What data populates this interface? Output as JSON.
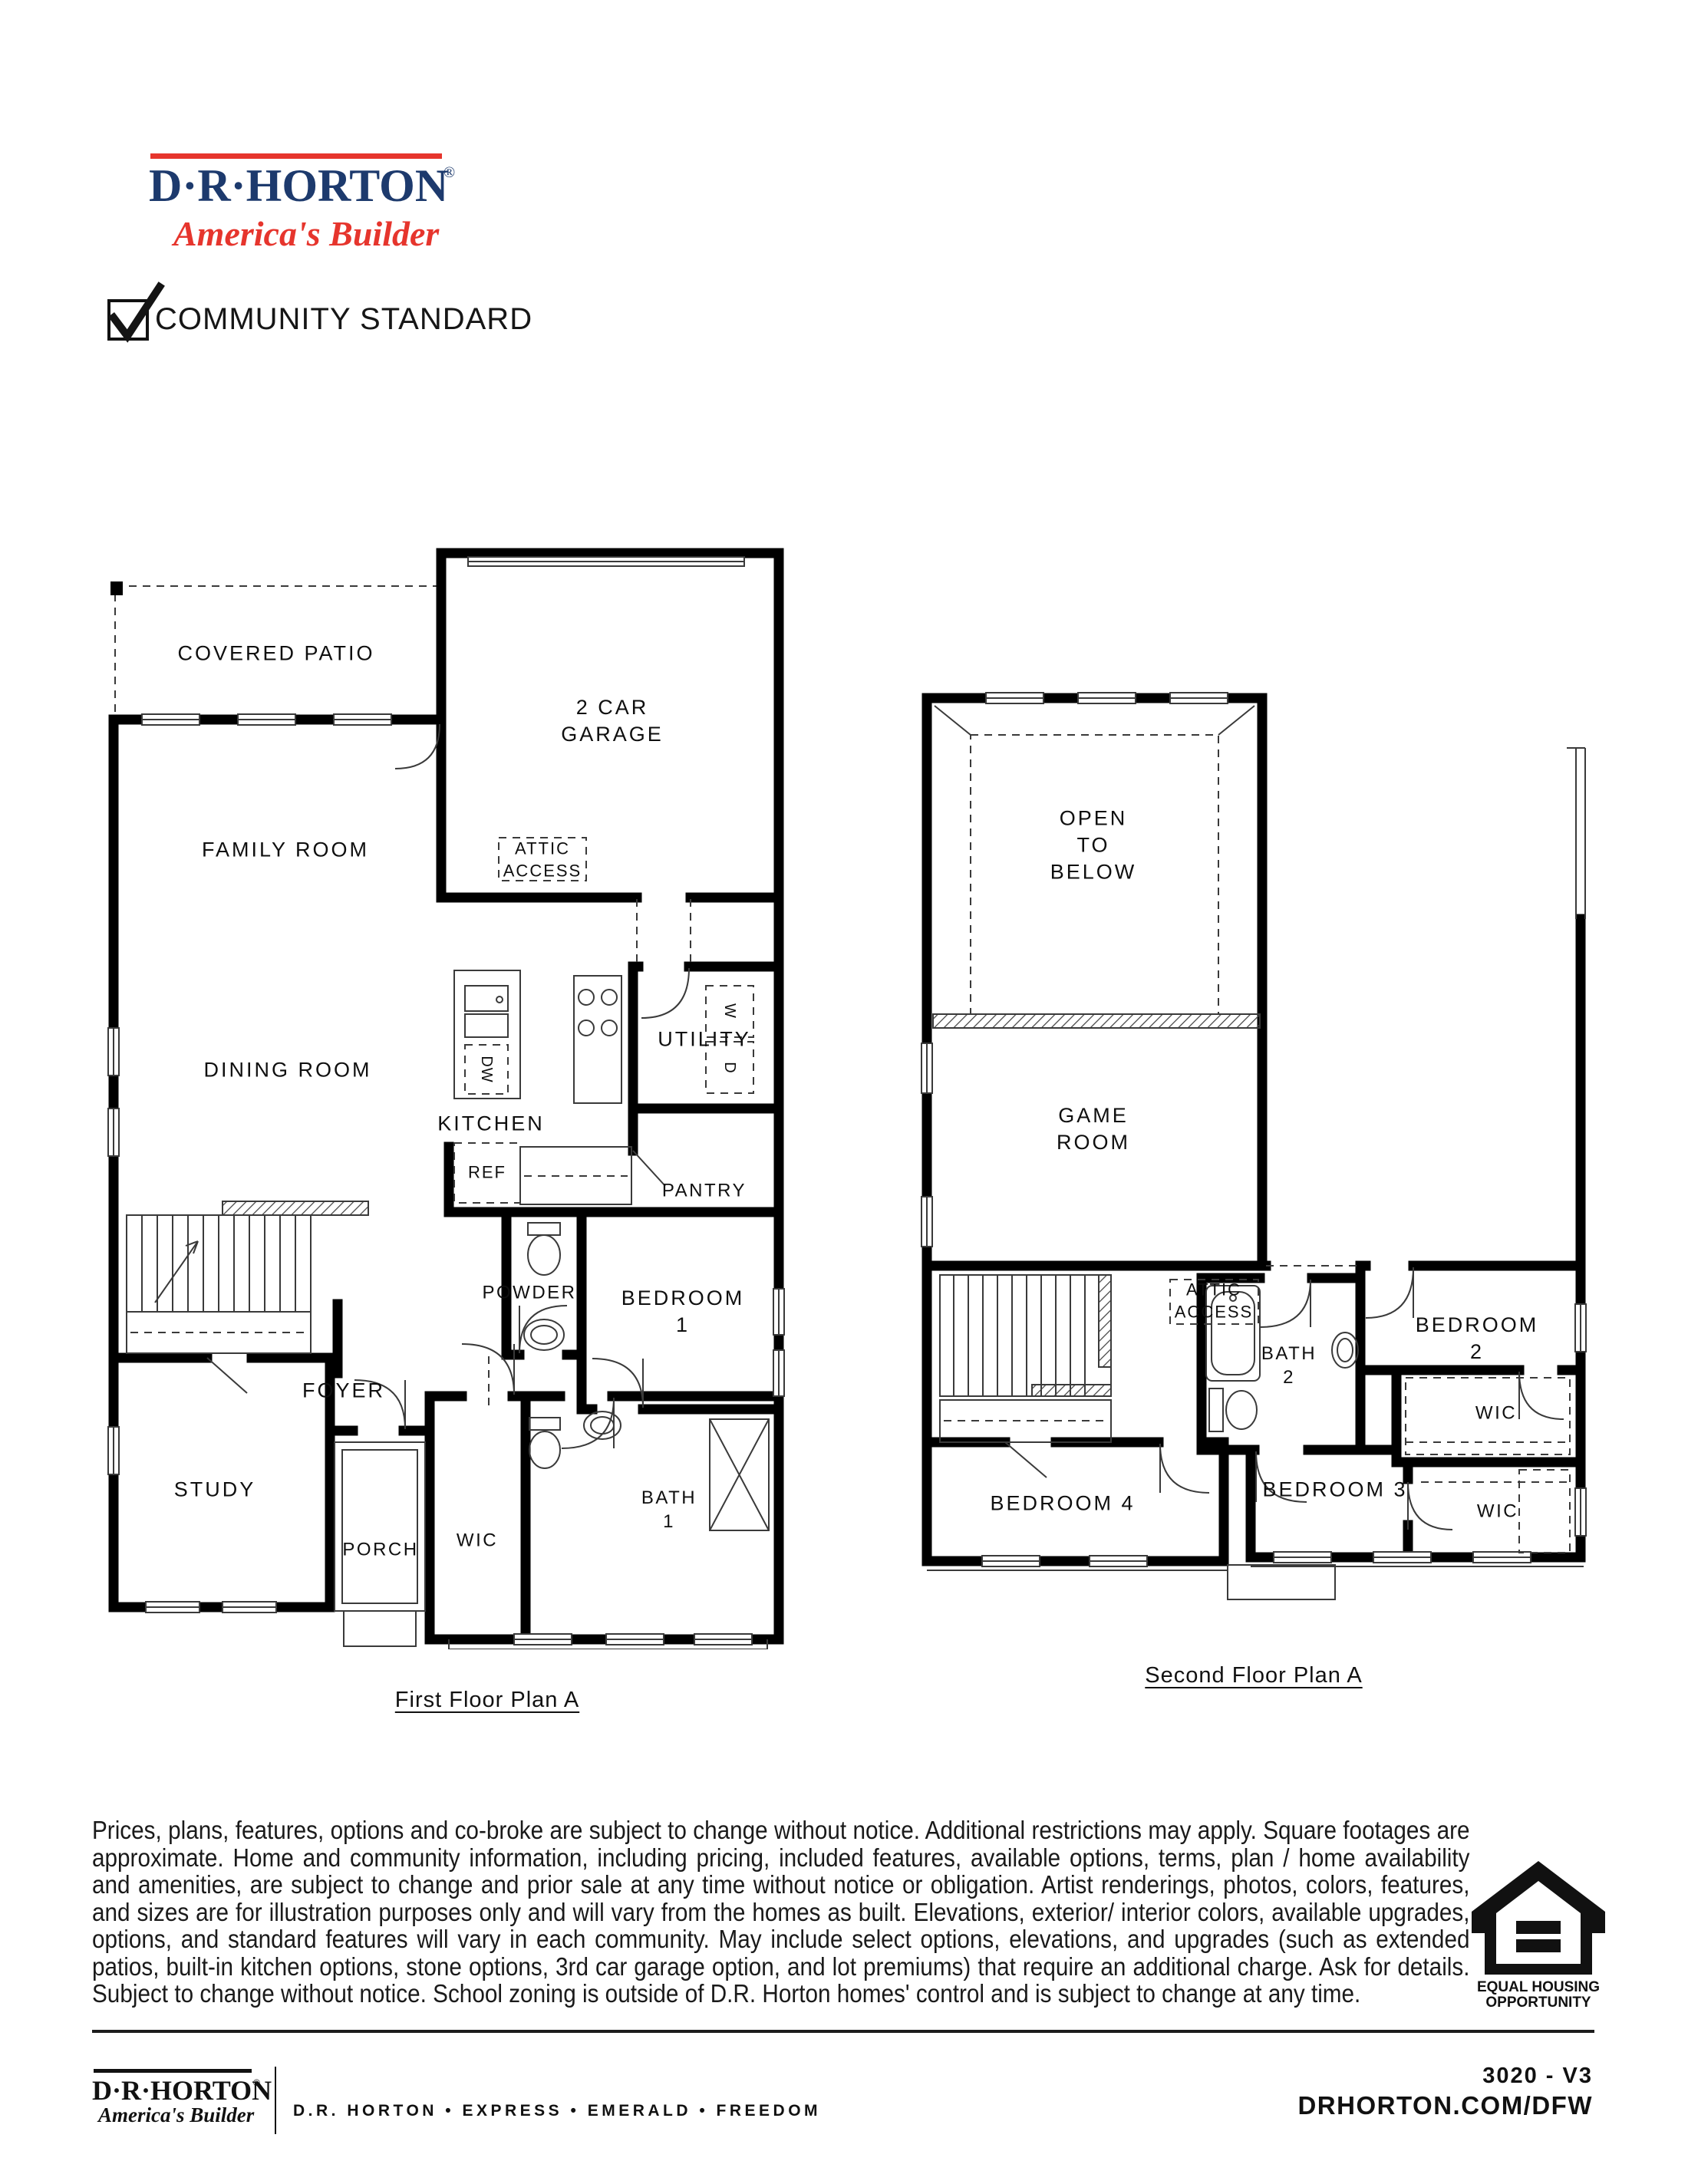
{
  "header": {
    "logo": {
      "brand": "D·R·HORTON",
      "registered": "®",
      "tagline": "America's Builder",
      "colors": {
        "navy": "#1d3a6d",
        "red": "#e6352d"
      }
    },
    "checkbox": {
      "label": "COMMUNITY STANDARD",
      "checked": true
    }
  },
  "first_floor": {
    "caption": "First Floor Plan A",
    "labels": {
      "covered_patio": "COVERED PATIO",
      "garage": "2 CAR GARAGE",
      "attic_access": "ATTIC\nACCESS",
      "family_room": "FAMILY ROOM",
      "dining_room": "DINING ROOM",
      "kitchen": "KITCHEN",
      "dishwasher": "DW",
      "utility": "UTILITY",
      "washer": "W",
      "dryer": "D",
      "refrigerator": "REF",
      "pantry": "PANTRY",
      "powder": "POWDER",
      "bedroom_1": "BEDROOM 1",
      "foyer": "FOYER",
      "study": "STUDY",
      "porch": "PORCH",
      "wic": "WIC",
      "bath_1": "BATH\n1"
    }
  },
  "second_floor": {
    "caption": "Second Floor Plan A",
    "labels": {
      "open_to_below": "OPEN\nTO\nBELOW",
      "game_room": "GAME\nROOM",
      "attic_access": "ATTIC\nACCESS",
      "bath_2": "BATH\n2",
      "bedroom_2": "BEDROOM 2",
      "bedroom_4": "BEDROOM 4",
      "bedroom_3": "BEDROOM 3",
      "wic_upper": "WIC",
      "wic_lower": "WIC"
    }
  },
  "disclaimer": "Prices, plans, features, options and co-broke are subject to change without notice. Additional restrictions may apply.  Square footages are approximate. Home and community information, including pricing, included features, available options, terms, plan / home availability and amenities, are subject to change and prior sale at any time without notice or obligation. Artist renderings, photos, colors, features, and sizes are for illustration purposes only and will vary from the homes as built. Elevations, exterior/ interior colors, available upgrades, options, and standard features will vary in each community. May include select options, elevations, and upgrades (such as extended patios, built-in kitchen options, stone options, 3rd car garage option, and lot premiums) that require an additional charge. Ask for details. Subject to change without notice. School zoning is outside of D.R. Horton homes' control and is subject to change at any time.",
  "equal_housing": {
    "line1": "EQUAL HOUSING",
    "line2": "OPPORTUNITY"
  },
  "footer": {
    "logo": {
      "brand": "D·R·HORTON",
      "registered": "®",
      "tagline": "America's Builder"
    },
    "brands": "D.R. HORTON • EXPRESS • EMERALD • FREEDOM",
    "plan_code": "3020 - V3",
    "website": "DRHORTON.COM/DFW"
  }
}
